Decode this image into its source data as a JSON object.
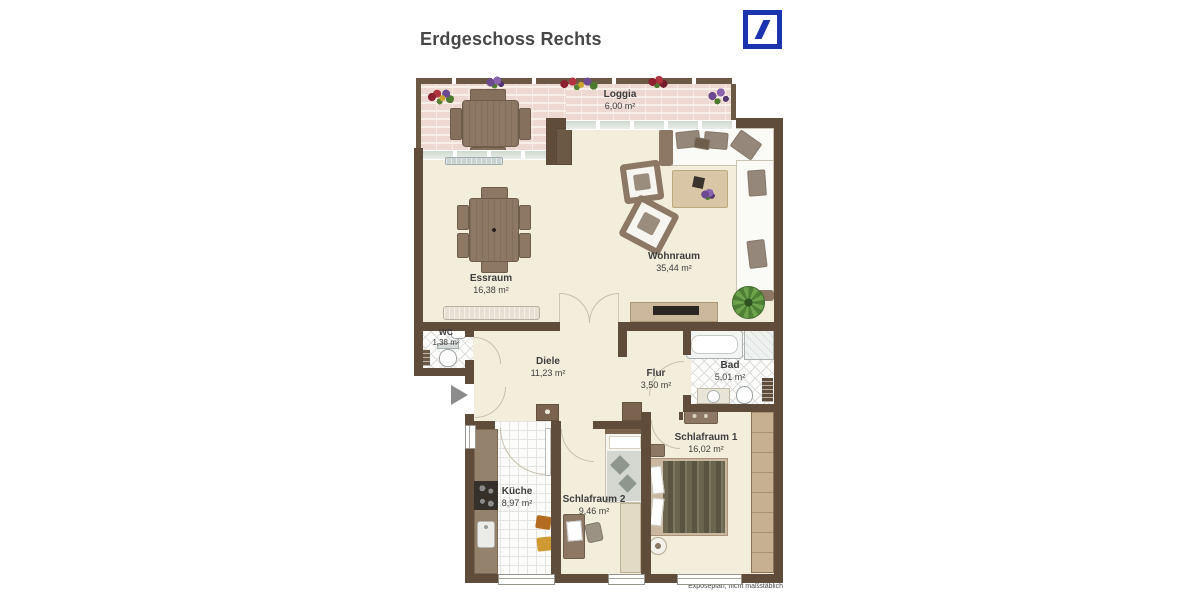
{
  "header": {
    "title": "Erdgeschoss Rechts"
  },
  "logo": {
    "icon": "deutsche-bank-slash-logo"
  },
  "rooms": [
    {
      "id": "loggia",
      "label": "Loggia",
      "area": "6,00 m²"
    },
    {
      "id": "wohnraum",
      "label": "Wohnraum",
      "area": "35,44 m²"
    },
    {
      "id": "essraum",
      "label": "Essraum",
      "area": "16,38 m²"
    },
    {
      "id": "wc",
      "label": "WC",
      "area": "1,38 m²"
    },
    {
      "id": "diele",
      "label": "Diele",
      "area": "11,23 m²"
    },
    {
      "id": "flur",
      "label": "Flur",
      "area": "3,50 m²"
    },
    {
      "id": "bad",
      "label": "Bad",
      "area": "5,01 m²"
    },
    {
      "id": "schlafraum1",
      "label": "Schlafraum 1",
      "area": "16,02 m²"
    },
    {
      "id": "kueche",
      "label": "Küche",
      "area": "8,97 m²"
    },
    {
      "id": "schlafraum2",
      "label": "Schlafraum 2",
      "area": "9,46 m²"
    }
  ],
  "footer": {
    "note": "Exposéplan, nicht maßstäblich"
  },
  "icons": {
    "entrance_arrow": "right-pointing-triangle"
  },
  "colors": {
    "wall": "#5f4c3b",
    "floor": "#f3eedb",
    "loggia_brick": "#eed9d2",
    "tile_line": "#dcdcdc",
    "logo_blue": "#1b33ae",
    "label_text": "#3d3d3d"
  }
}
